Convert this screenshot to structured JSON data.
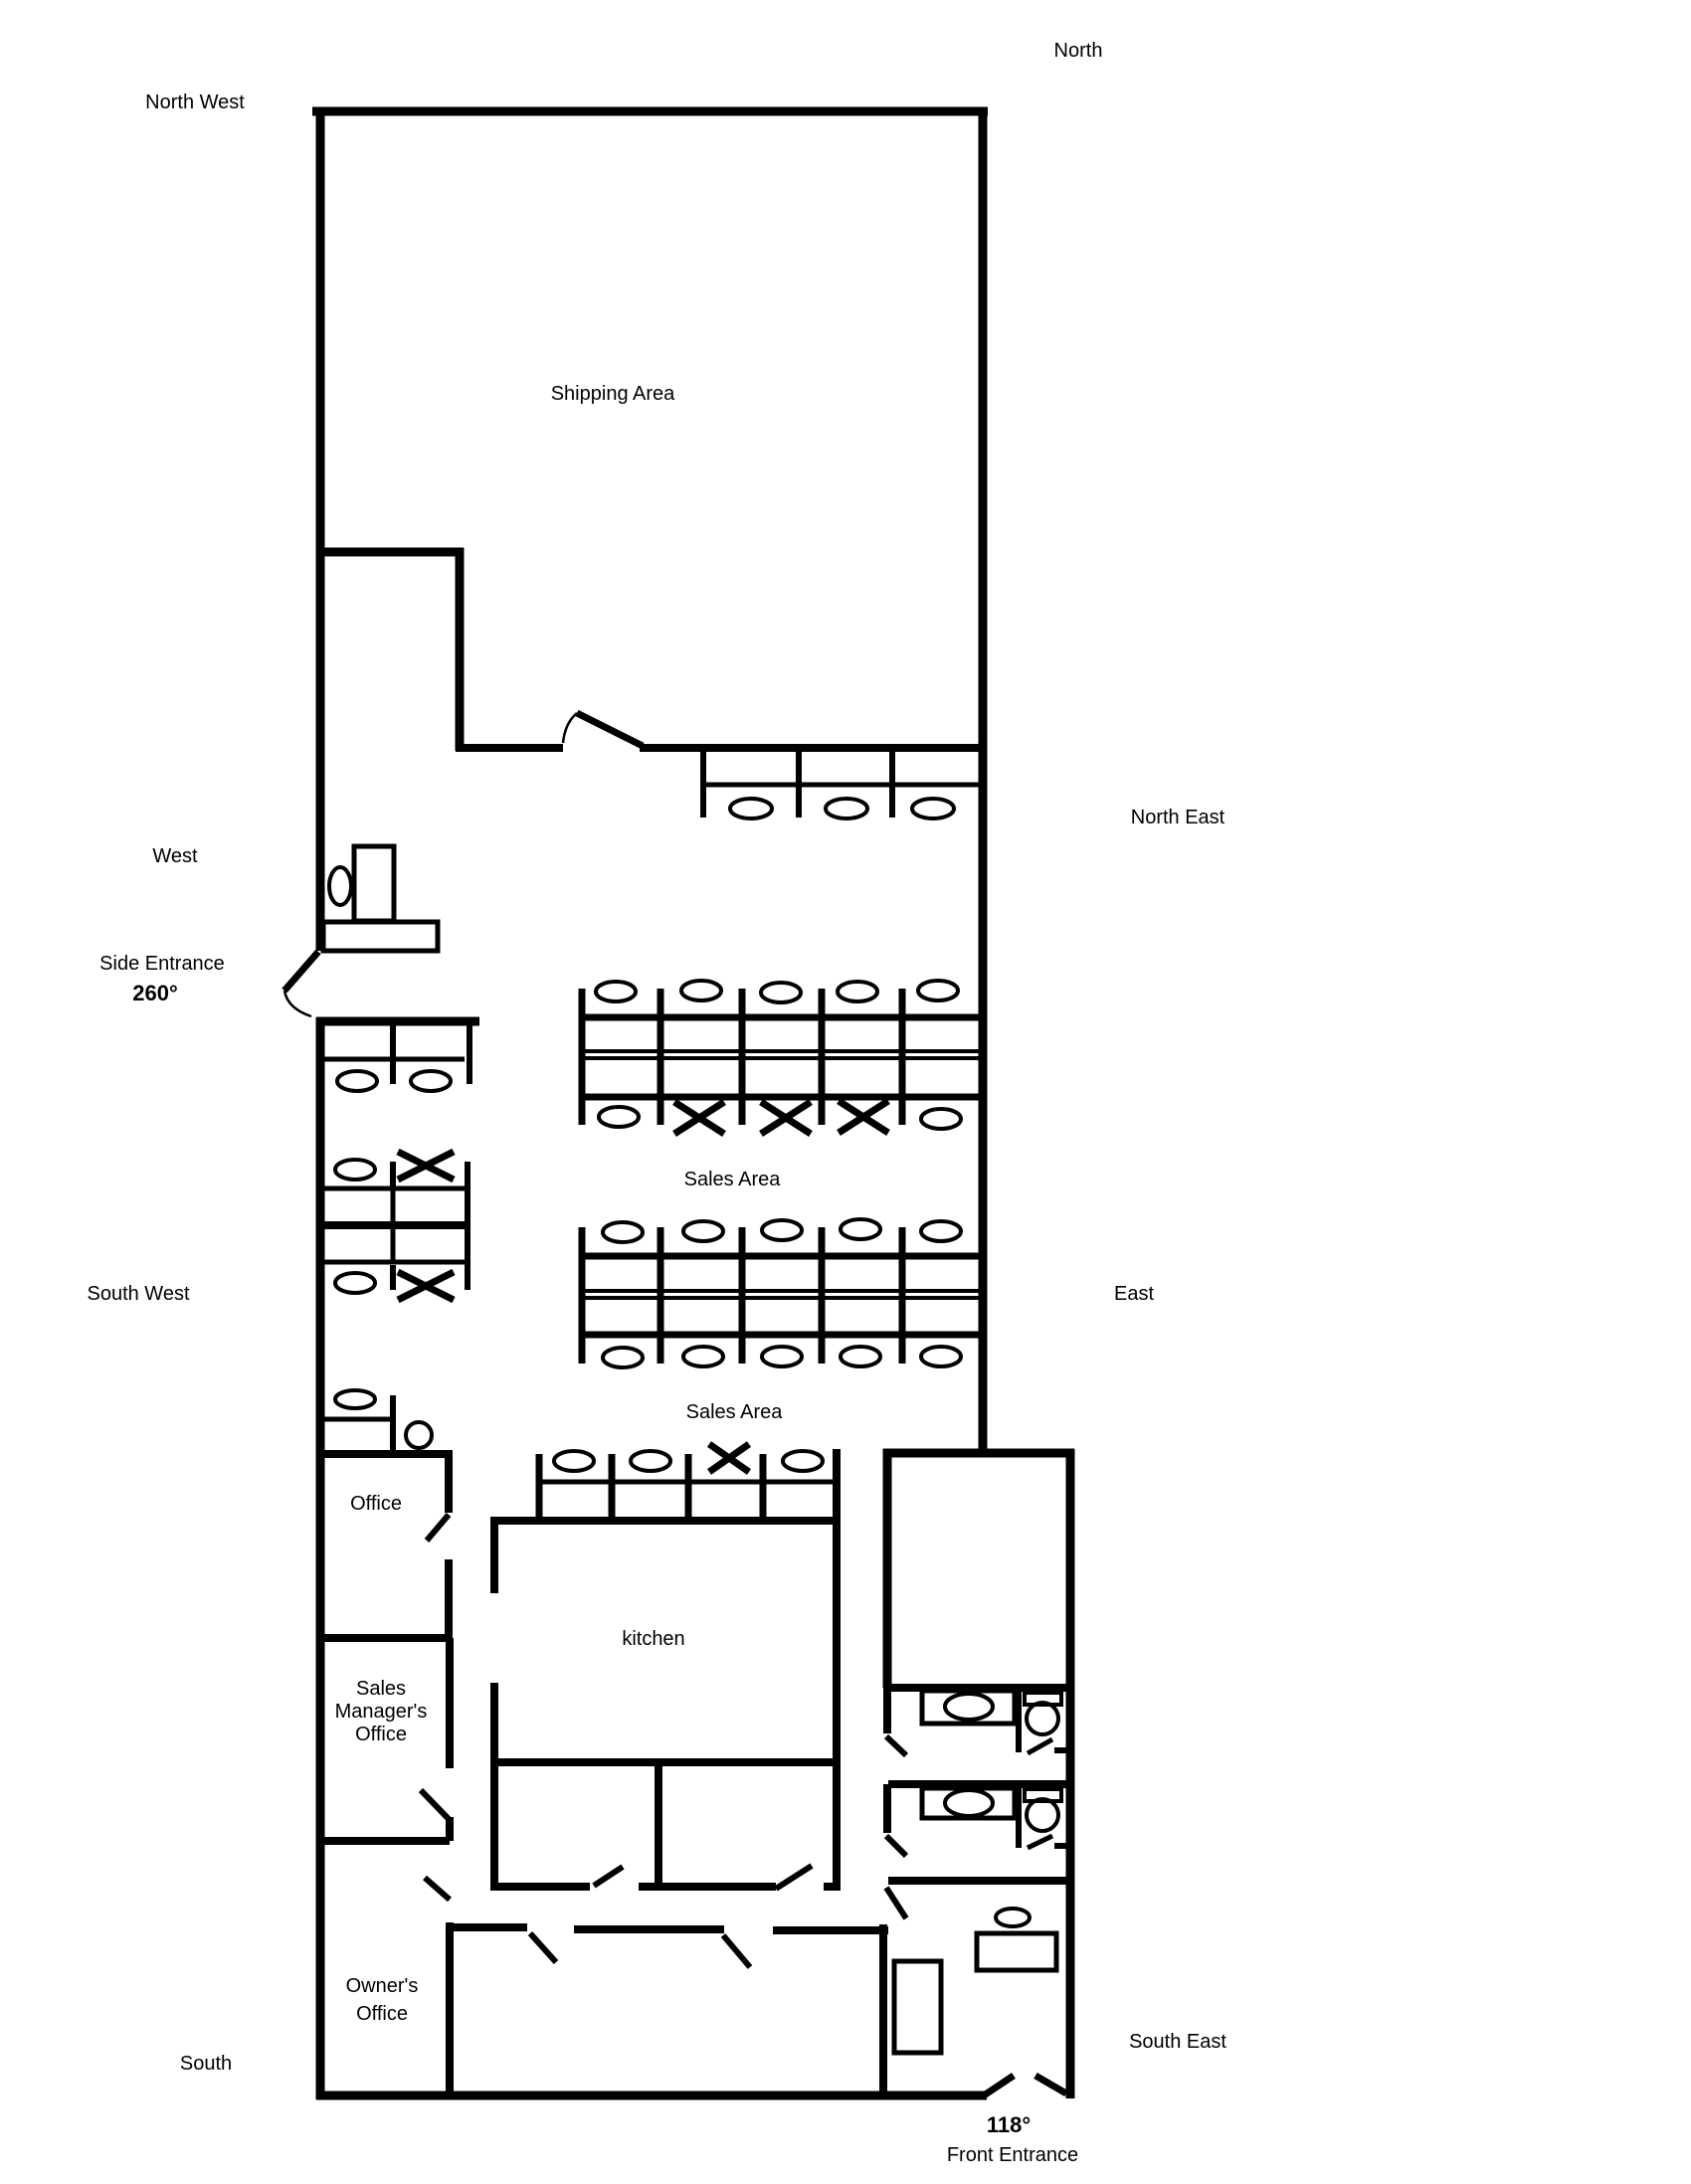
{
  "diagram_type": "office-floor-plan",
  "compass": {
    "north": "North",
    "north_west": "North West",
    "north_east": "North East",
    "west": "West",
    "east": "East",
    "south_west": "South West",
    "south_east": "South East",
    "south": "South"
  },
  "areas": {
    "shipping_area": "Shipping Area",
    "sales_area_upper": "Sales Area",
    "sales_area_lower": "Sales Area",
    "office": "Office",
    "kitchen": "kitchen",
    "sales_managers_office": {
      "line1": "Sales",
      "line2": "Manager's",
      "line3": "Office"
    },
    "owners_office": {
      "line1": "Owner's",
      "line2": "Office"
    }
  },
  "entrances": {
    "side": {
      "label": "Side Entrance",
      "angle": "260°"
    },
    "front": {
      "label": "Front Entrance",
      "angle": "118°"
    }
  },
  "colors": {
    "wall": "#000000",
    "background": "#ffffff"
  }
}
